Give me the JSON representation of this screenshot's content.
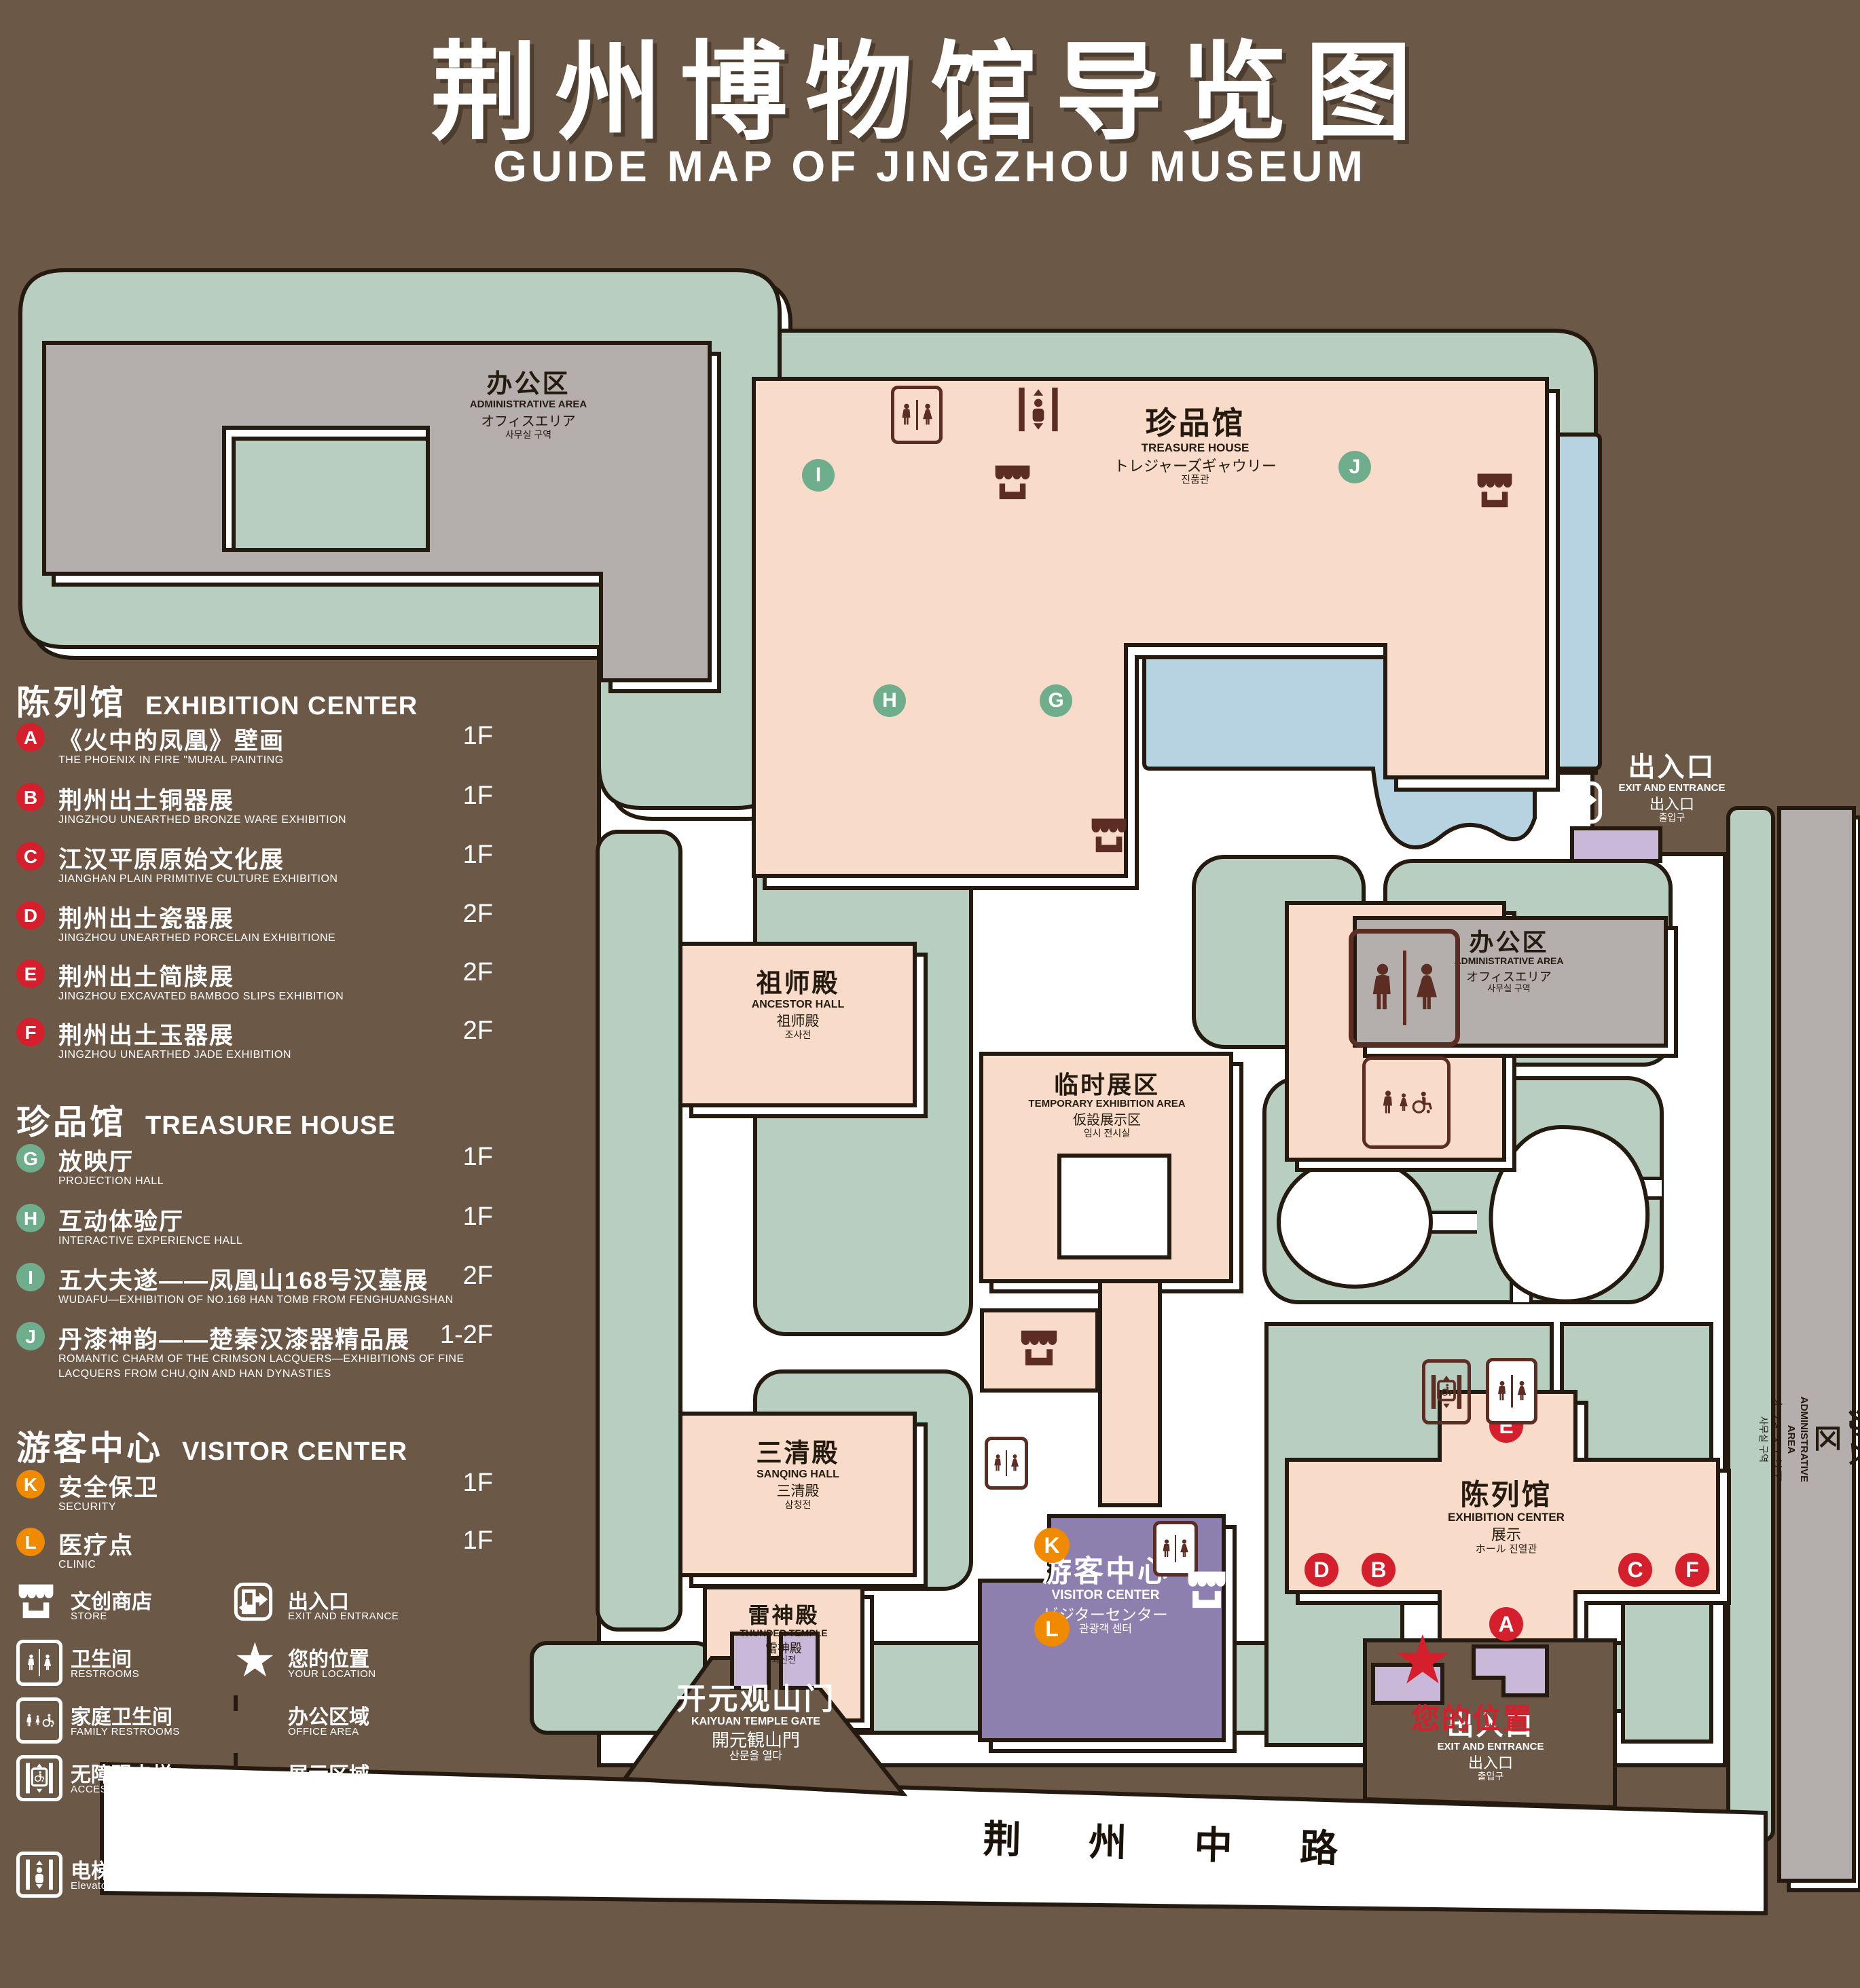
{
  "title": {
    "cn": "荆州博物馆导览图",
    "en": "GUIDE MAP OF JINGZHOU MUSEUM"
  },
  "colors": {
    "background": "#6b5847",
    "lawn_green": "#b8cec1",
    "display_pink": "#f8dcc9",
    "office_gray": "#b4afac",
    "pond_blue": "#b7d2e1",
    "visitor_purple": "#8d7fae",
    "gate_purple": "#c9b8d8",
    "marker_red": "#d61f2c",
    "marker_green": "#6fae8c",
    "marker_orange": "#f08a00",
    "outline": "#241a10",
    "icon_brown": "#5b2d23",
    "white": "#ffffff"
  },
  "legend": {
    "sections": [
      {
        "cn": "陈列馆",
        "en": "EXHIBITION CENTER",
        "items": [
          {
            "letter": "A",
            "cn": "《火中的凤凰》壁画",
            "en": "THE PHOENIX IN FIRE \"MURAL PAINTING",
            "floor": "1F"
          },
          {
            "letter": "B",
            "cn": "荆州出土铜器展",
            "en": "JINGZHOU UNEARTHED BRONZE WARE EXHIBITION",
            "floor": "1F"
          },
          {
            "letter": "C",
            "cn": "江汉平原原始文化展",
            "en": "JIANGHAN PLAIN PRIMITIVE CULTURE EXHIBITION",
            "floor": "1F"
          },
          {
            "letter": "D",
            "cn": "荆州出土瓷器展",
            "en": "JINGZHOU UNEARTHED PORCELAIN EXHIBITIONE",
            "floor": "2F"
          },
          {
            "letter": "E",
            "cn": "荆州出土简牍展",
            "en": "JINGZHOU EXCAVATED BAMBOO SLIPS EXHIBITION",
            "floor": "2F"
          },
          {
            "letter": "F",
            "cn": "荆州出土玉器展",
            "en": "JINGZHOU UNEARTHED JADE EXHIBITION",
            "floor": "2F"
          }
        ]
      },
      {
        "cn": "珍品馆",
        "en": "TREASURE HOUSE",
        "items": [
          {
            "letter": "G",
            "cn": "放映厅",
            "en": "PROJECTION HALL",
            "floor": "1F"
          },
          {
            "letter": "H",
            "cn": "互动体验厅",
            "en": "INTERACTIVE EXPERIENCE HALL",
            "floor": "1F"
          },
          {
            "letter": "I",
            "cn": "五大夫遂——凤凰山168号汉墓展",
            "en": "WUDAFU—EXHIBITION OF NO.168 HAN TOMB FROM FENGHUANGSHAN",
            "floor": "2F"
          },
          {
            "letter": "J",
            "cn": "丹漆神韵——楚秦汉漆器精品展",
            "en": "ROMANTIC CHARM OF THE CRIMSON LACQUERS—EXHIBITIONS OF FINE LACQUERS FROM CHU,QIN AND HAN DYNASTIES",
            "floor": "1-2F"
          }
        ]
      },
      {
        "cn": "游客中心",
        "en": "VISITOR CENTER",
        "items": [
          {
            "letter": "K",
            "cn": "安全保卫",
            "en": "SECURITY",
            "floor": "1F"
          },
          {
            "letter": "L",
            "cn": "医疗点",
            "en": "CLINIC",
            "floor": "1F"
          }
        ]
      }
    ],
    "symbols": [
      {
        "name": "store",
        "cn": "文创商店",
        "en": "STORE"
      },
      {
        "name": "exit",
        "cn": "出入口",
        "en": "EXIT AND ENTRANCE"
      },
      {
        "name": "restrooms",
        "cn": "卫生间",
        "en": "RESTROOMS"
      },
      {
        "name": "your-location",
        "cn": "您的位置",
        "en": "YOUR LOCATION"
      },
      {
        "name": "family-restrooms",
        "cn": "家庭卫生间",
        "en": "FAMILY RESTROOMS"
      },
      {
        "name": "office-area",
        "cn": "办公区域",
        "en": "OFFICE AREA"
      },
      {
        "name": "accessible-elevator",
        "cn": "无障碍电梯",
        "en": "ACCESSIBLE ELEVATOR"
      },
      {
        "name": "display-area",
        "cn": "展示区域",
        "en": "DISPLAY AREA"
      },
      {
        "name": "elevator",
        "cn": "电梯",
        "en": "Elevator"
      }
    ]
  },
  "map": {
    "admin_nw": {
      "cn": "办公区",
      "en": "ADMINISTRATIVE AREA",
      "jp": "オフィスエリア",
      "kr": "사무실 구역"
    },
    "treasure": {
      "cn": "珍品馆",
      "en": "TREASURE HOUSE",
      "jp": "トレジャーズギャウリー",
      "kr": "진품관"
    },
    "ancestor": {
      "cn": "祖师殿",
      "en": "ANCESTOR HALL",
      "jp": "祖师殿",
      "kr": "조사전"
    },
    "sanqing": {
      "cn": "三清殿",
      "en": "SANQING HALL",
      "jp": "三清殿",
      "kr": "삼청전"
    },
    "thunder": {
      "cn": "雷神殿",
      "en": "THUNDER TEMPLE",
      "jp": "雷神殿",
      "kr": "뇌신전"
    },
    "temp": {
      "cn": "临时展区",
      "en": "TEMPORARY EXHIBITION AREA",
      "jp": "仮設展示区",
      "kr": "임시 전시실"
    },
    "admin_c": {
      "cn": "办公区",
      "en": "ADMINISTRATIVE AREA",
      "jp": "オフィスエリア",
      "kr": "사무실 구역"
    },
    "admin_r": {
      "cn": "办公区",
      "en": "ADMINISTRATIVE AREA",
      "jp": "オフィスエリア",
      "kr": "사무실 구역"
    },
    "exhibition": {
      "cn": "陈列馆",
      "en": "EXHIBITION CENTER",
      "l3": "展示",
      "l4": "ホール 진열관"
    },
    "visitor": {
      "cn": "游客中心",
      "en": "VISITOR CENTER",
      "jp": "ビジターセンター",
      "kr": "관광객 센터"
    },
    "gate": {
      "cn": "开元观山门",
      "en": "KAIYUAN TEMPLE GATE",
      "jp": "開元観山門",
      "kr": "산문을 열다"
    },
    "exit_e": {
      "cn": "出入口",
      "en": "EXIT AND ENTRANCE",
      "jp": "出入口",
      "kr": "출입구"
    },
    "exit_s": {
      "cn": "出入口",
      "en": "EXIT AND ENTRANCE",
      "jp": "出入口",
      "kr": "출입구"
    },
    "road": "荆 州 中 路",
    "your_location": "您的位置",
    "markers": [
      {
        "letter": "A"
      },
      {
        "letter": "B"
      },
      {
        "letter": "C"
      },
      {
        "letter": "D"
      },
      {
        "letter": "E"
      },
      {
        "letter": "F"
      },
      {
        "letter": "G"
      },
      {
        "letter": "H"
      },
      {
        "letter": "I"
      },
      {
        "letter": "J"
      },
      {
        "letter": "K"
      },
      {
        "letter": "L"
      }
    ]
  }
}
